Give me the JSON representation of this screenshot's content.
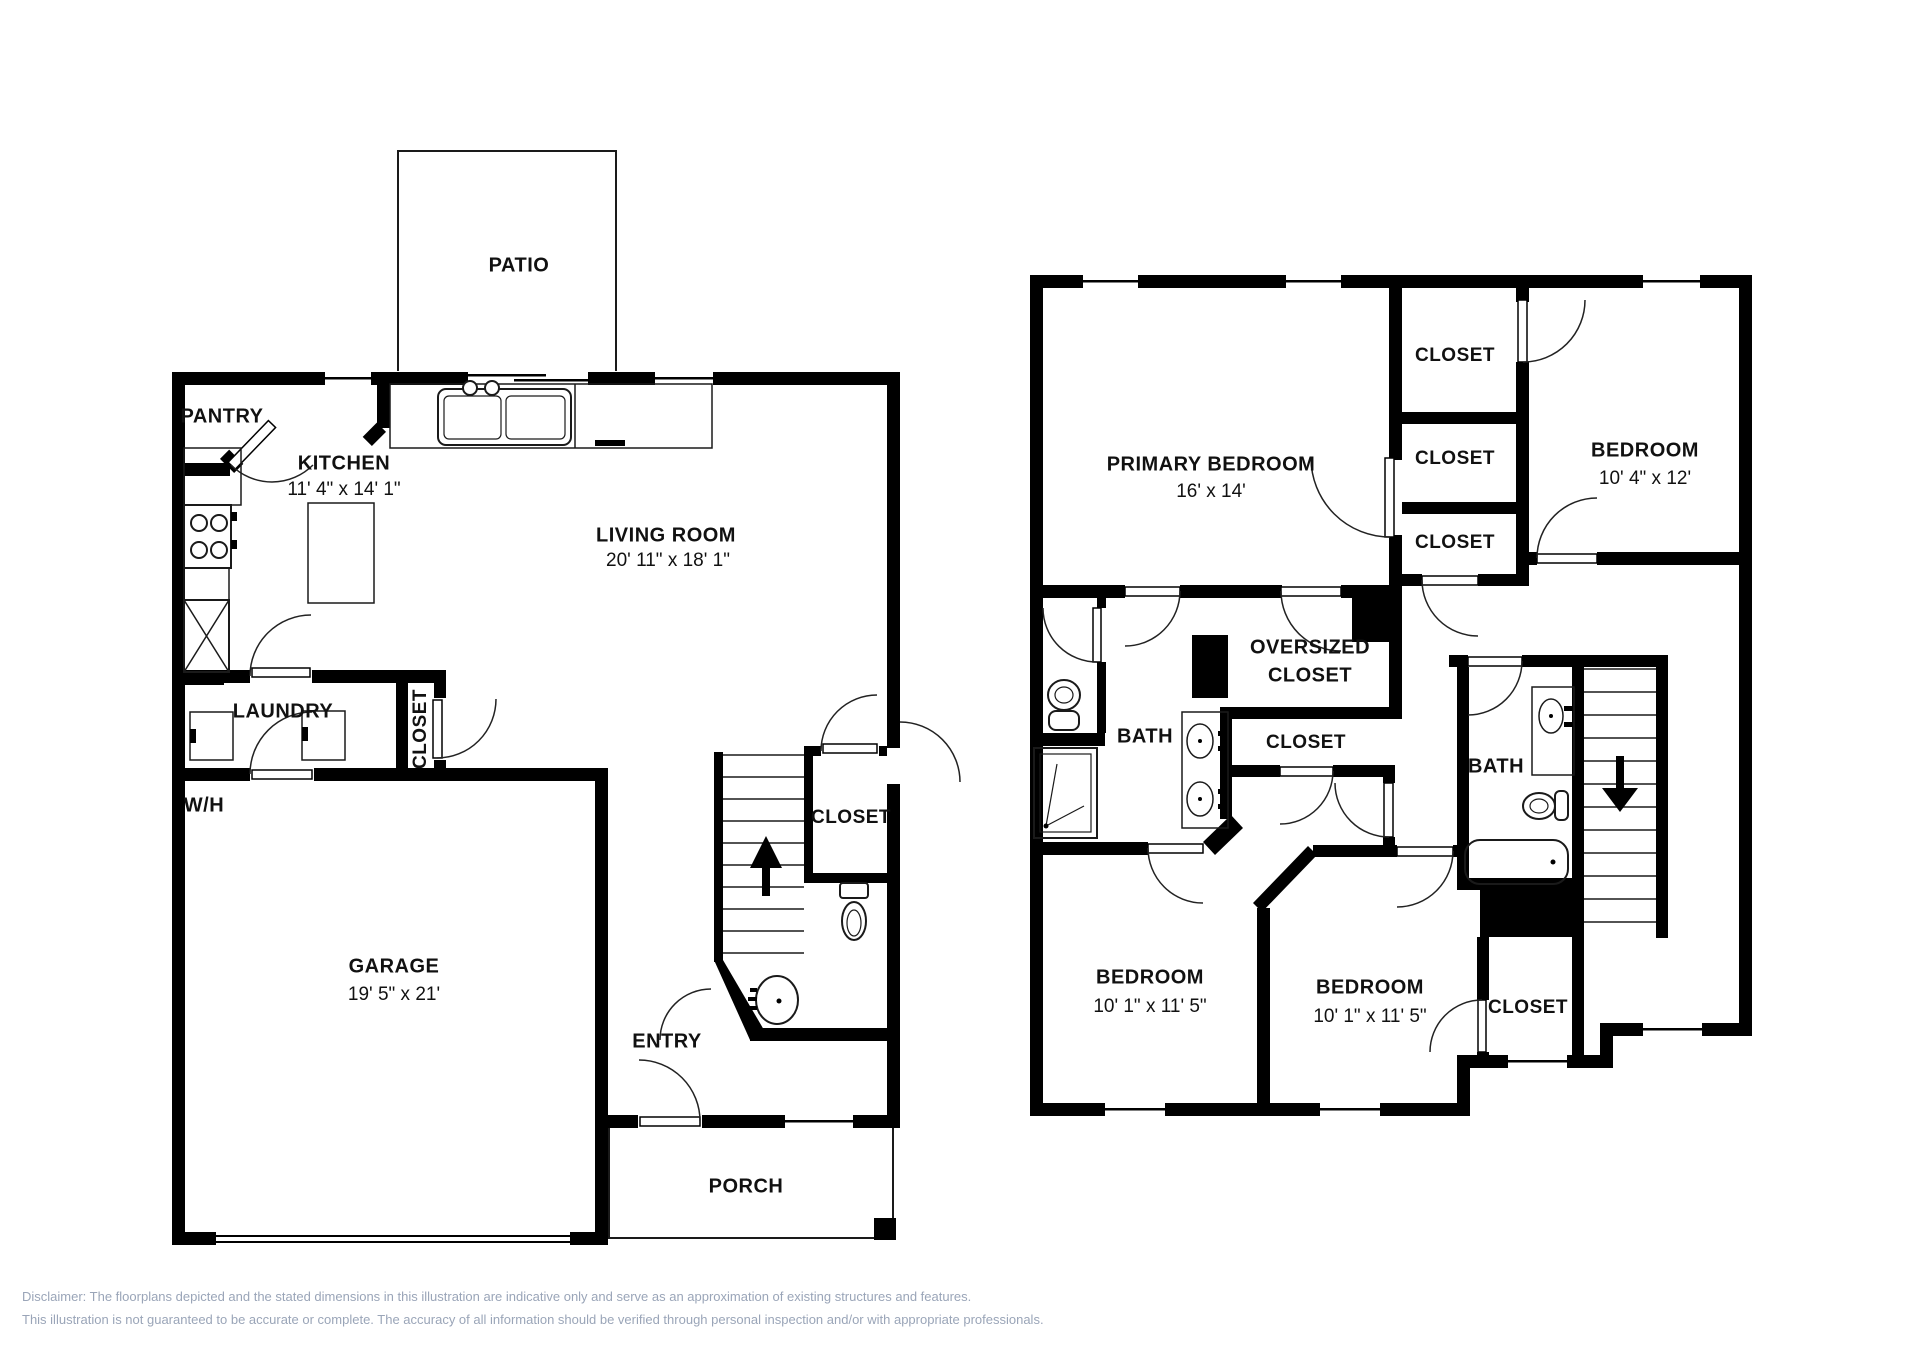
{
  "floor1": {
    "patio": "PATIO",
    "pantry": "PANTRY",
    "kitchen": {
      "name": "KITCHEN",
      "dims": "11' 4\" x 14' 1\""
    },
    "living_room": {
      "name": "LIVING ROOM",
      "dims": "20' 11\" x 18' 1\""
    },
    "laundry": "LAUNDRY",
    "laundry_closet": "CLOSET",
    "water_heater": "W/H",
    "garage": {
      "name": "GARAGE",
      "dims": "19' 5\" x 21'"
    },
    "entry": "ENTRY",
    "stair_closet": "CLOSET",
    "porch": "PORCH"
  },
  "floor2": {
    "primary_bedroom": {
      "name": "PRIMARY BEDROOM",
      "dims": "16' x 14'"
    },
    "closet1": "CLOSET",
    "closet2": "CLOSET",
    "closet3": "CLOSET",
    "bedroom_right": {
      "name": "BEDROOM",
      "dims": "10' 4\" x 12'"
    },
    "bath_left": "BATH",
    "oversized_closet": {
      "line1": "OVERSIZED",
      "line2": "CLOSET"
    },
    "closet_mid": "CLOSET",
    "bath_right": "BATH",
    "bedroom_bottom_left": {
      "name": "BEDROOM",
      "dims": "10' 1\" x 11' 5\""
    },
    "bedroom_bottom_mid": {
      "name": "BEDROOM",
      "dims": "10' 1\" x 11' 5\""
    },
    "closet_bottom_right": "CLOSET"
  },
  "disclaimer": {
    "line1": "Disclaimer: The floorplans depicted and the stated dimensions in this illustration are indicative only and serve as an approximation of existing structures and features.",
    "line2": "This illustration is not guaranteed to be accurate or complete. The accuracy of all information should be verified through personal inspection and/or with appropriate professionals."
  },
  "colors": {
    "wall": "#000000",
    "text": "#111111",
    "disclaimer": "#9aa5b8"
  }
}
